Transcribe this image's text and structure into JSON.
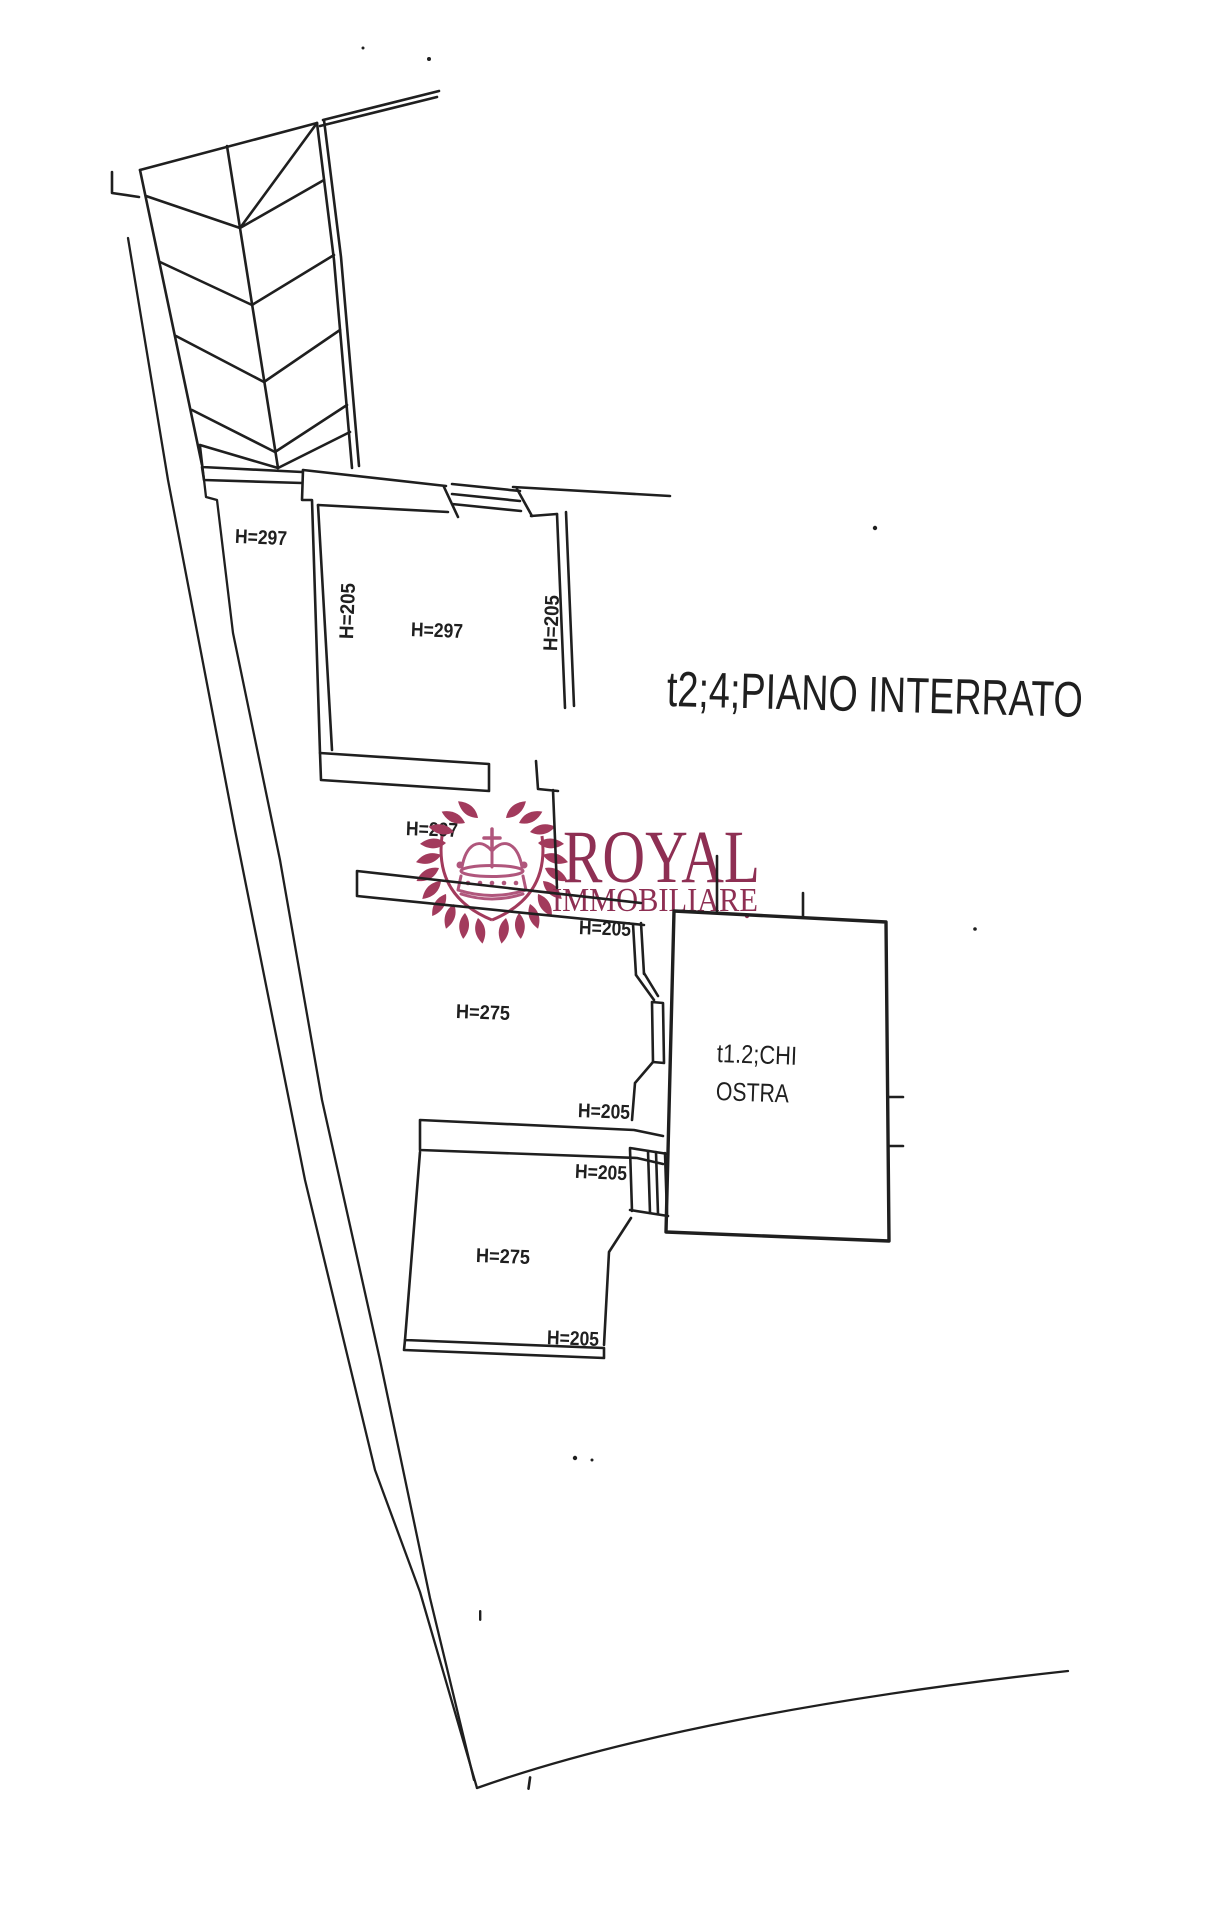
{
  "page": {
    "background": "#ffffff",
    "ink": "#1f1f1f"
  },
  "title": {
    "text": "t2;4;PIANO INTERRATO"
  },
  "watermark": {
    "line1": "ROYAL",
    "line2": "IMMOBILIARE",
    "text_color": "#8e2f53",
    "leaf_color": "#a23a5c",
    "crown_color": "#b0567c"
  },
  "labels": [
    {
      "id": "h297-upper-left-room",
      "text": "H=297"
    },
    {
      "id": "h297-big-room",
      "text": "H=297"
    },
    {
      "id": "h205-left-wall",
      "text": "H=205"
    },
    {
      "id": "h205-right-wall",
      "text": "H=205"
    },
    {
      "id": "h297-corridor",
      "text": "H=297"
    },
    {
      "id": "h205-door-upper",
      "text": "H=205"
    },
    {
      "id": "h275-room-1",
      "text": "H=275"
    },
    {
      "id": "h205-door-middle",
      "text": "H=205"
    },
    {
      "id": "h205-door-lower",
      "text": "H=205"
    },
    {
      "id": "h275-room-2",
      "text": "H=275"
    },
    {
      "id": "h205-bottom",
      "text": "H=205"
    }
  ],
  "room_right": {
    "line1": "t1.2;CHI",
    "line2": "OSTRA"
  }
}
